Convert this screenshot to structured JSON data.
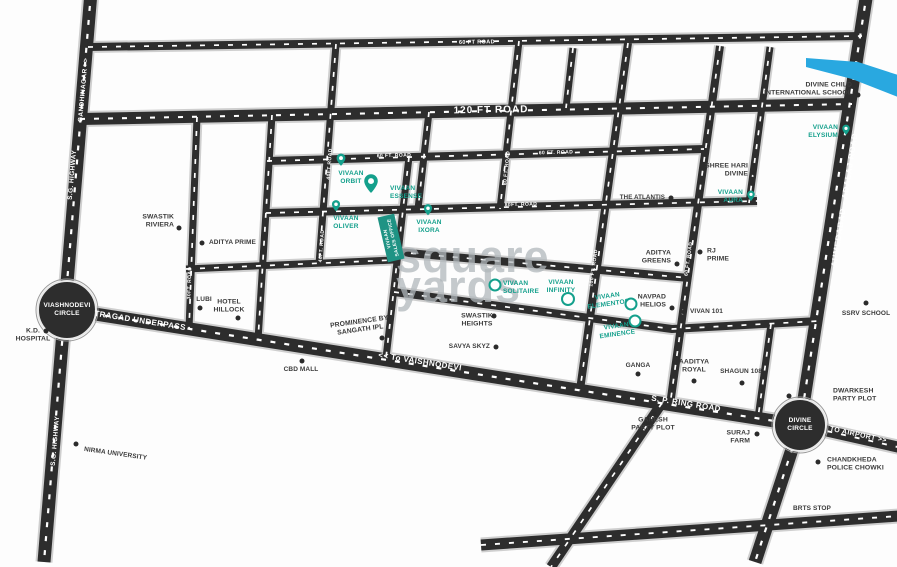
{
  "watermark": {
    "line1": "square",
    "line2": "yards"
  },
  "colors": {
    "accent": "#14A08C",
    "road": "#2d2d2d",
    "casing": "#cfcfcf",
    "dash": "#ffffff",
    "river": "#29A8E0",
    "poi_text": "#3b3b3b",
    "background": "#fdfdfd"
  },
  "sales_office": {
    "lines": [
      "VIVAAN",
      "SALES OFFICE"
    ]
  },
  "circles": [
    {
      "name": "viashnodevi-circle",
      "lines": [
        "VIASHNODEVI",
        "CIRCLE"
      ],
      "x": 67,
      "y": 310,
      "r": 29
    },
    {
      "name": "divine-circle",
      "lines": [
        "DIVINE",
        "CIRCLE"
      ],
      "x": 800,
      "y": 425,
      "r": 26
    }
  ],
  "river": {
    "points": [
      [
        806,
        58
      ],
      [
        858,
        62
      ],
      [
        898,
        75
      ],
      [
        898,
        97
      ],
      [
        852,
        79
      ],
      [
        806,
        67
      ]
    ]
  },
  "roads": [
    {
      "id": "sg-highway",
      "points": [
        [
          91,
          -8
        ],
        [
          44,
          562
        ]
      ],
      "w": 13
    },
    {
      "id": "adalaj-road",
      "points": [
        [
          867,
          -8
        ],
        [
          800,
          425
        ],
        [
          755,
          562
        ]
      ],
      "w": 13
    },
    {
      "id": "airport-road",
      "points": [
        [
          800,
          425
        ],
        [
          902,
          448
        ]
      ],
      "w": 11
    },
    {
      "id": "ring-road",
      "points": [
        [
          63,
          309
        ],
        [
          800,
          425
        ]
      ],
      "w": 13
    },
    {
      "id": "bottom-road",
      "points": [
        [
          481,
          545
        ],
        [
          899,
          516
        ]
      ],
      "w": 11
    },
    {
      "id": "bottom-diagonal",
      "points": [
        [
          662,
          403
        ],
        [
          551,
          567
        ]
      ],
      "w": 10
    },
    {
      "id": "road-60ft-top",
      "points": [
        [
          88,
          47
        ],
        [
          862,
          36
        ]
      ],
      "w": 8
    },
    {
      "id": "road-120ft",
      "points": [
        [
          80,
          119
        ],
        [
          852,
          104
        ]
      ],
      "w": 12
    },
    {
      "id": "road-60ft-mid",
      "points": [
        [
          267,
          161
        ],
        [
          704,
          149
        ]
      ],
      "w": 8
    },
    {
      "id": "road-80ft",
      "points": [
        [
          266,
          213
        ],
        [
          757,
          201
        ]
      ],
      "w": 8
    },
    {
      "id": "road-h5",
      "points": [
        [
          186,
          269
        ],
        [
          394,
          260
        ]
      ],
      "w": 7
    },
    {
      "id": "road-a",
      "points": [
        [
          397,
          252
        ],
        [
          689,
          278
        ]
      ],
      "w": 8
    },
    {
      "id": "road-b",
      "points": [
        [
          394,
          292
        ],
        [
          672,
          329
        ],
        [
          819,
          321
        ]
      ],
      "w": 8
    },
    {
      "id": "v1-30ft",
      "points": [
        [
          197,
          117
        ],
        [
          189,
          329
        ]
      ],
      "w": 7
    },
    {
      "id": "v2-30ft",
      "points": [
        [
          272,
          115
        ],
        [
          258,
          340
        ]
      ],
      "w": 7
    },
    {
      "id": "v3-40ft",
      "points": [
        [
          336,
          44
        ],
        [
          319,
          264
        ]
      ],
      "w": 7
    },
    {
      "id": "v4",
      "points": [
        [
          409,
          157
        ],
        [
          386,
          358
        ]
      ],
      "w": 7
    },
    {
      "id": "v5",
      "points": [
        [
          429,
          112
        ],
        [
          418,
          209
        ]
      ],
      "w": 7
    },
    {
      "id": "v6-60ft",
      "points": [
        [
          519,
          41
        ],
        [
          500,
          209
        ]
      ],
      "w": 7
    },
    {
      "id": "v7",
      "points": [
        [
          573,
          48
        ],
        [
          566,
          108
        ]
      ],
      "w": 7
    },
    {
      "id": "v-100ft",
      "points": [
        [
          628,
          43
        ],
        [
          580,
          390
        ]
      ],
      "w": 8
    },
    {
      "id": "v-60ft-long",
      "points": [
        [
          720,
          46
        ],
        [
          670,
          405
        ]
      ],
      "w": 8
    },
    {
      "id": "v-shree-right",
      "points": [
        [
          770,
          47
        ],
        [
          749,
          203
        ]
      ],
      "w": 7
    },
    {
      "id": "v-shagun-right",
      "points": [
        [
          771,
          324
        ],
        [
          758,
          418
        ]
      ],
      "w": 7
    }
  ],
  "road_labels": [
    {
      "text": "GANDHINAGAR >>",
      "x": 84,
      "y": 90,
      "rot": -85,
      "size": 6.5
    },
    {
      "text": "S.G. HIGHWAY",
      "x": 73,
      "y": 175,
      "rot": -85,
      "size": 6.5
    },
    {
      "text": "S.G. HIGHWAY",
      "x": 56,
      "y": 441,
      "rot": -85,
      "size": 6.5
    },
    {
      "text": "60 FT ROAD",
      "x": 477,
      "y": 43,
      "rot": -1,
      "size": 5.5
    },
    {
      "text": "120 FT ROAD",
      "x": 491,
      "y": 111,
      "rot": -1,
      "size": 10,
      "spacing": 1
    },
    {
      "text": "60 FT. ROAD",
      "x": 394,
      "y": 156,
      "rot": -1.5,
      "size": 5
    },
    {
      "text": "60 FT. ROAD",
      "x": 556,
      "y": 153,
      "rot": -1.5,
      "size": 5
    },
    {
      "text": "80FT. ROAD",
      "x": 521,
      "y": 205,
      "rot": -1.5,
      "size": 5
    },
    {
      "text": "40FT ROAD",
      "x": 330,
      "y": 164,
      "rot": -86,
      "size": 5
    },
    {
      "text": "40FT. ROAD",
      "x": 322,
      "y": 246,
      "rot": -86,
      "size": 5
    },
    {
      "text": "60 FT. ROAD",
      "x": 507,
      "y": 168,
      "rot": -84,
      "size": 5
    },
    {
      "text": "30FT. ROAD",
      "x": 190,
      "y": 283,
      "rot": -88,
      "size": 5
    },
    {
      "text": "30FT. ROAD",
      "x": 253,
      "y": 293,
      "rot": -86,
      "size": 5
    },
    {
      "text": "100 FT. ROAD",
      "x": 594,
      "y": 268,
      "rot": -82,
      "size": 5
    },
    {
      "text": "60 FT. ROAD",
      "x": 689,
      "y": 259,
      "rot": -82,
      "size": 5
    },
    {
      "text": "AHMEDABAD - ADALAJ ROAD",
      "x": 845,
      "y": 200,
      "rot": -81,
      "size": 8,
      "spacing": 0.8
    },
    {
      "text": "TRAGAD UNDERPASS",
      "x": 140,
      "y": 321,
      "rot": 9,
      "size": 8
    },
    {
      "text": "<< To VAISHNODEVI",
      "x": 420,
      "y": 362,
      "rot": 9,
      "size": 8
    },
    {
      "text": "S. P. RING ROAD",
      "x": 686,
      "y": 404,
      "rot": 9,
      "size": 8
    },
    {
      "text": "TO AIRPORT >>",
      "x": 858,
      "y": 436,
      "rot": 12,
      "size": 7
    }
  ],
  "projects": [
    {
      "name": "vivaan-orbit",
      "lines": [
        "VIVAAN",
        "ORBIT"
      ],
      "marker": "pin",
      "pin": [
        341,
        160
      ],
      "pin_size": 13,
      "label": [
        351,
        178
      ],
      "align": "center"
    },
    {
      "name": "vivaan-essense",
      "lines": [
        "VIVAAN",
        "ESSENSE"
      ],
      "marker": "pin",
      "pin": [
        371,
        184
      ],
      "pin_size": 20,
      "label": [
        390,
        193
      ],
      "align": "left"
    },
    {
      "name": "vivaan-oliver",
      "lines": [
        "VIVAAN",
        "OLIVER"
      ],
      "marker": "pin",
      "pin": [
        336,
        206
      ],
      "pin_size": 12,
      "label": [
        346,
        223
      ],
      "align": "center"
    },
    {
      "name": "vivaan-ixora",
      "lines": [
        "VIVAAN",
        "IXORA"
      ],
      "marker": "pin",
      "pin": [
        428,
        210
      ],
      "pin_size": 12,
      "label": [
        429,
        227
      ],
      "align": "center"
    },
    {
      "name": "vivaan-elysium",
      "lines": [
        "VIVAAN",
        "ELYSIUM"
      ],
      "marker": "pin",
      "pin": [
        846,
        130
      ],
      "pin_size": 11,
      "label": [
        838,
        132
      ],
      "align": "right"
    },
    {
      "name": "vivaan-aura",
      "lines": [
        "VIVAAN",
        "AURA"
      ],
      "marker": "pin",
      "pin": [
        751,
        196
      ],
      "pin_size": 11,
      "label": [
        743,
        197
      ],
      "align": "right"
    },
    {
      "name": "vivaan-solitaire",
      "lines": [
        "VIVAAN",
        "SOLITAIRE"
      ],
      "marker": "ring",
      "pin": [
        495,
        285
      ],
      "pin_size": 9,
      "label": [
        503,
        288
      ],
      "align": "left"
    },
    {
      "name": "vivaan-infinity",
      "lines": [
        "VIVAAN",
        "INFINITY"
      ],
      "marker": "ring",
      "pin": [
        568,
        299
      ],
      "pin_size": 10,
      "label": [
        561,
        287
      ],
      "align": "center"
    },
    {
      "name": "vivaan-elementos",
      "lines": [
        "VIVAAN",
        "ELEMENTOS"
      ],
      "marker": "ring",
      "pin": [
        631,
        304
      ],
      "pin_size": 9,
      "label": [
        608,
        301
      ],
      "align": "center",
      "rot": -8
    },
    {
      "name": "vivaan-eminence",
      "lines": [
        "VIVAAN",
        "EMINENCE"
      ],
      "marker": "ring",
      "pin": [
        635,
        321
      ],
      "pin_size": 9,
      "label": [
        617,
        331
      ],
      "align": "center",
      "rot": -8
    }
  ],
  "pois": [
    {
      "name": "divine-child-international-school",
      "lines": [
        "DIVINE CHILD",
        "INTERNATIONAL SCHOOL"
      ],
      "label": [
        852,
        90
      ],
      "align": "right",
      "dot": [
        858,
        95
      ]
    },
    {
      "name": "shree-hari-divine",
      "lines": [
        "SHREE HARI",
        "DIVINE"
      ],
      "label": [
        748,
        171
      ],
      "align": "right",
      "dot": [
        754,
        173
      ]
    },
    {
      "name": "the-atlantis",
      "lines": [
        "THE ATLANTIS"
      ],
      "label": [
        665,
        198
      ],
      "align": "right",
      "dot": [
        671,
        198
      ],
      "size": 6.2
    },
    {
      "name": "aditya-greens",
      "lines": [
        "ADITYA",
        "GREENS"
      ],
      "label": [
        671,
        258
      ],
      "align": "right",
      "dot": [
        677,
        264
      ]
    },
    {
      "name": "rj-prime",
      "lines": [
        "RJ",
        "PRIME"
      ],
      "label": [
        707,
        256
      ],
      "align": "left",
      "dot": [
        700,
        252
      ]
    },
    {
      "name": "swastik-riviera",
      "lines": [
        "SWASTIK",
        "RIVIERA"
      ],
      "label": [
        174,
        222
      ],
      "align": "right",
      "dot": [
        179,
        228
      ]
    },
    {
      "name": "aditya-prime",
      "lines": [
        "ADITYA PRIME"
      ],
      "label": [
        209,
        243
      ],
      "align": "left",
      "dot": [
        202,
        243
      ],
      "size": 6.5
    },
    {
      "name": "lubi",
      "lines": [
        "LUBI"
      ],
      "label": [
        204,
        300
      ],
      "align": "center",
      "dot": [
        200,
        308
      ],
      "size": 6.5
    },
    {
      "name": "hotel-hillock",
      "lines": [
        "HOTEL",
        "HILLOCK"
      ],
      "label": [
        229,
        307
      ],
      "align": "center",
      "dot": [
        238,
        318
      ]
    },
    {
      "name": "kd-hospital",
      "lines": [
        "K.D.",
        "HOSPITAL"
      ],
      "label": [
        33,
        336
      ],
      "align": "center",
      "dot": [
        46,
        331
      ]
    },
    {
      "name": "prominence-by-sangath-ipl",
      "lines": [
        "PROMINENCE BY",
        "SANGATH IPL"
      ],
      "label": [
        360,
        327
      ],
      "align": "center",
      "rot": -8,
      "dot": [
        382,
        338
      ]
    },
    {
      "name": "swastik-heights",
      "lines": [
        "SWASTIK",
        "HEIGHTS"
      ],
      "label": [
        477,
        321
      ],
      "align": "center",
      "dot": [
        494,
        316
      ]
    },
    {
      "name": "savya-skyz",
      "lines": [
        "SAVYA SKYZ"
      ],
      "label": [
        490,
        347
      ],
      "align": "right",
      "dot": [
        496,
        347
      ],
      "size": 6.5
    },
    {
      "name": "cbd-mall",
      "lines": [
        "CBD MALL"
      ],
      "label": [
        301,
        370
      ],
      "align": "center",
      "dot": [
        302,
        361
      ],
      "size": 6.5
    },
    {
      "name": "nirma-university",
      "lines": [
        "NIRMA UNIVERSITY"
      ],
      "label": [
        84,
        450
      ],
      "align": "left",
      "rot": 8,
      "dot": [
        76,
        444
      ],
      "size": 6.5
    },
    {
      "name": "navpad-helios",
      "lines": [
        "NAVPAD",
        "HELIOS"
      ],
      "label": [
        666,
        302
      ],
      "align": "right",
      "dot": [
        672,
        308
      ]
    },
    {
      "name": "vivan-101",
      "lines": [
        "VIVAN 101"
      ],
      "label": [
        690,
        312
      ],
      "align": "left",
      "dot": [
        684,
        312
      ],
      "size": 6.5
    },
    {
      "name": "ssrv-school",
      "lines": [
        "SSRV SCHOOL"
      ],
      "label": [
        866,
        314
      ],
      "align": "center",
      "dot": [
        866,
        303
      ],
      "size": 6.5
    },
    {
      "name": "ganga",
      "lines": [
        "GANGA"
      ],
      "label": [
        638,
        366
      ],
      "align": "center",
      "dot": [
        638,
        374
      ],
      "size": 6.5
    },
    {
      "name": "aaditya-royal",
      "lines": [
        "AADITYA",
        "ROYAL"
      ],
      "label": [
        694,
        367
      ],
      "align": "center",
      "dot": [
        694,
        381
      ]
    },
    {
      "name": "shagun-108",
      "lines": [
        "SHAGUN 108"
      ],
      "label": [
        741,
        372
      ],
      "align": "center",
      "dot": [
        742,
        383
      ],
      "size": 6.5
    },
    {
      "name": "dwarkesh-party-plot",
      "lines": [
        "DWARKESH",
        "PARTY PLOT"
      ],
      "label": [
        833,
        396
      ],
      "align": "left",
      "dot": [
        789,
        396
      ]
    },
    {
      "name": "ganesh-party-plot",
      "lines": [
        "GANESH",
        "PARTY PLOT"
      ],
      "label": [
        653,
        425
      ],
      "align": "center",
      "dot": [
        654,
        414
      ]
    },
    {
      "name": "suraj-farm",
      "lines": [
        "SURAJ",
        "FARM"
      ],
      "label": [
        750,
        438
      ],
      "align": "right",
      "dot": [
        757,
        434
      ]
    },
    {
      "name": "chandkheda-police-chowki",
      "lines": [
        "CHANDKHEDA",
        "POLICE CHOWKI"
      ],
      "label": [
        827,
        465
      ],
      "align": "left",
      "dot": [
        818,
        462
      ]
    },
    {
      "name": "brts-stop",
      "lines": [
        "BRTS STOP"
      ],
      "label": [
        812,
        509
      ],
      "align": "center",
      "size": 6.5
    }
  ]
}
